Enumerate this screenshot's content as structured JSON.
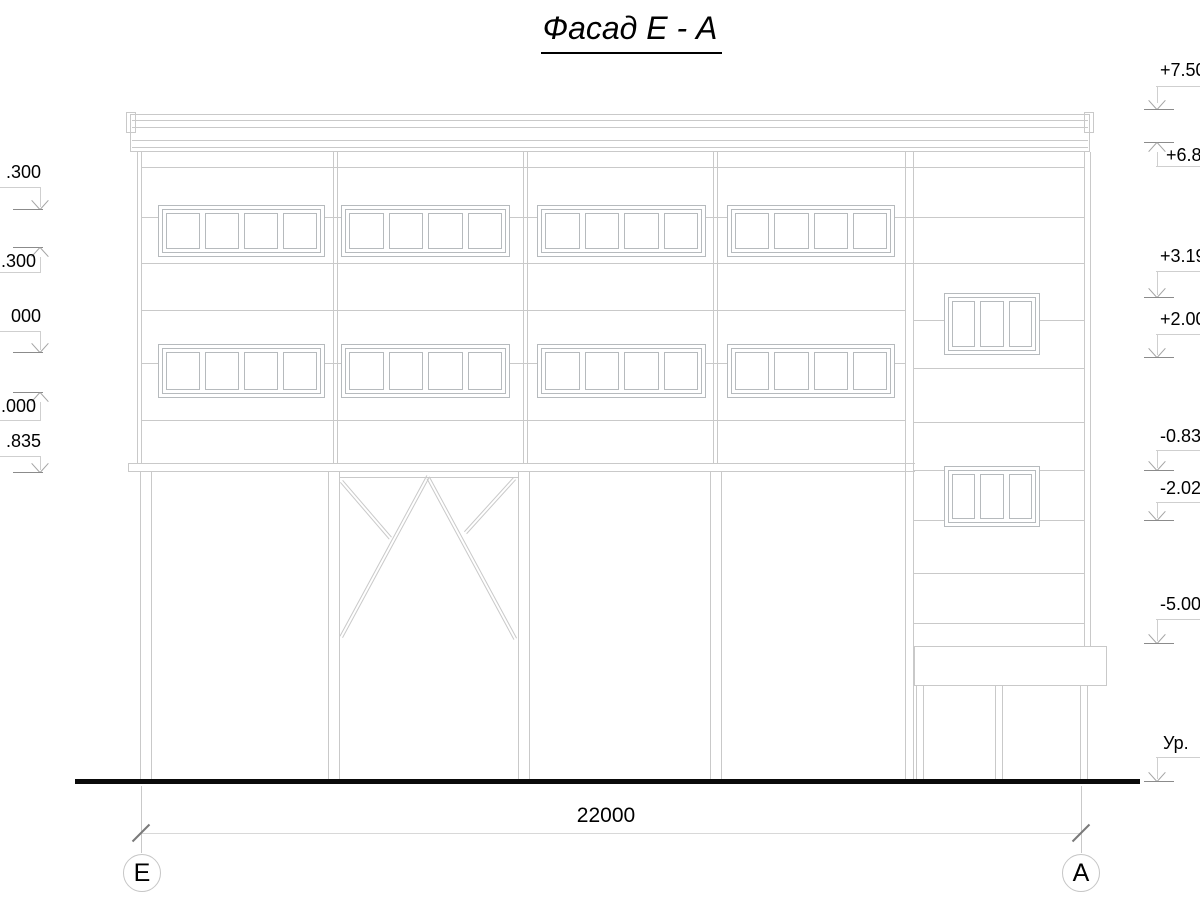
{
  "title": "Фасад Е - А",
  "dimension": {
    "label": "22000"
  },
  "axes": {
    "left_label": "Е",
    "right_label": "А"
  },
  "elevations": {
    "left": {
      "m1": ".300",
      "m2": ".300",
      "m3": "000",
      "m4": ".000",
      "m5": ".835"
    },
    "right": {
      "m1": "+7.50",
      "m2": "+6.8",
      "m3": "+3.19",
      "m4": "+2.00",
      "m5": "-0.83",
      "m6": "-2.02",
      "m7": "-5.00",
      "ground": "Ур."
    }
  },
  "colors": {
    "drawing_line": "#c9c9c9",
    "window_frame": "#b6babd",
    "level_tick": "#8b8b8b",
    "text": "#000000",
    "ground_line": "#0a0a0a"
  }
}
